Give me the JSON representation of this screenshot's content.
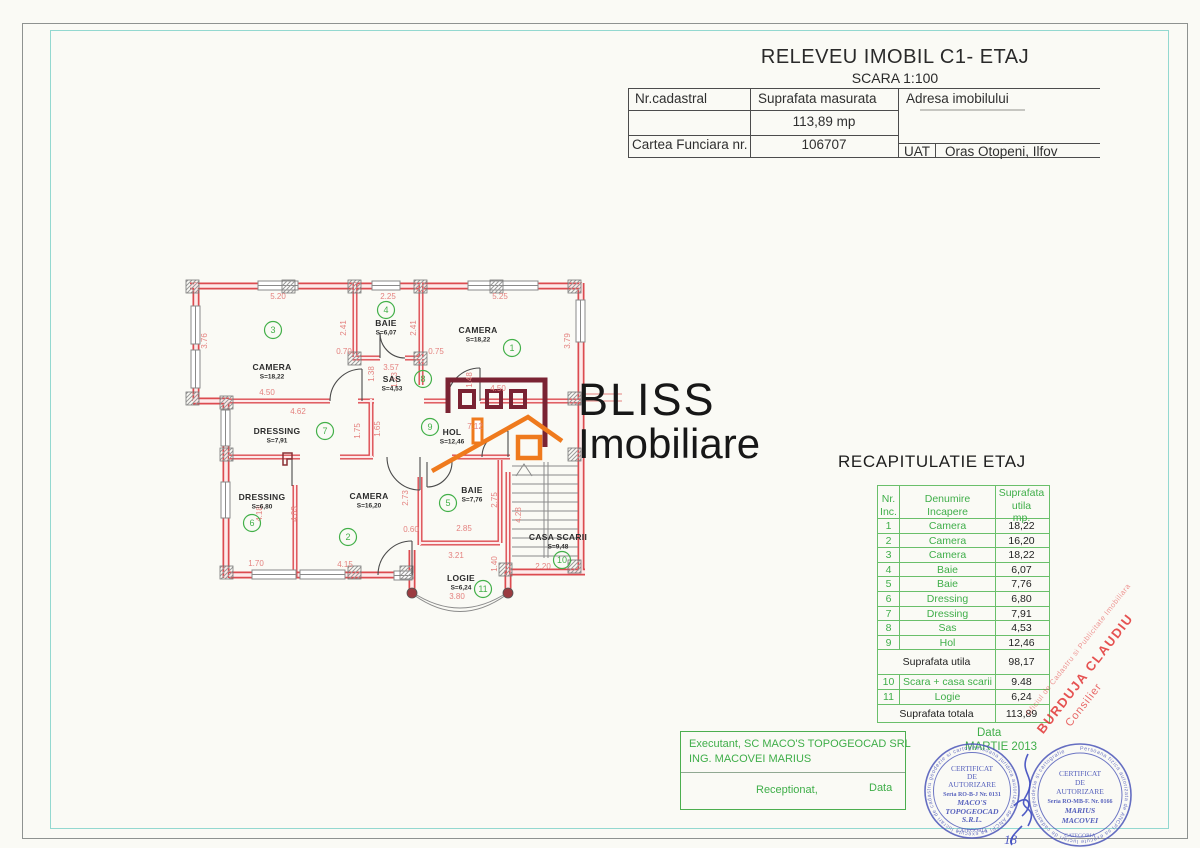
{
  "page": {
    "title": "RELEVEU IMOBIL C1- ETAJ",
    "subtitle": "SCARA 1:100"
  },
  "header_table": {
    "col1": "Nr.cadastral",
    "col2": "Suprafata masurata",
    "col3": "Adresa imobilului",
    "measured_area": "113,89 mp",
    "row2_label": "Cartea Funciara nr.",
    "row2_value": "106707",
    "uat_label": "UAT",
    "uat_value": "Oras Otopeni, Ilfov"
  },
  "logo": {
    "line1": "BLISS",
    "line2": "Imobiliare",
    "maroon": "#7a2333",
    "orange": "#ef7a1d"
  },
  "recap": {
    "title": "RECAPITULATIE ETAJ",
    "header": {
      "c1": [
        "Nr.",
        "Inc."
      ],
      "c2": [
        "Denumire",
        "Incapere"
      ],
      "c3": [
        "Suprafata",
        "utila",
        "mp."
      ]
    },
    "rows": [
      {
        "nr": "1",
        "name": "Camera",
        "val": "18,22"
      },
      {
        "nr": "2",
        "name": "Camera",
        "val": "16,20"
      },
      {
        "nr": "3",
        "name": "Camera",
        "val": "18,22"
      },
      {
        "nr": "4",
        "name": "Baie",
        "val": "6,07"
      },
      {
        "nr": "5",
        "name": "Baie",
        "val": "7,76"
      },
      {
        "nr": "6",
        "name": "Dressing",
        "val": "6,80"
      },
      {
        "nr": "7",
        "name": "Dressing",
        "val": "7,91"
      },
      {
        "nr": "8",
        "name": "Sas",
        "val": "4,53"
      },
      {
        "nr": "9",
        "name": "Hol",
        "val": "12,46"
      }
    ],
    "subtotal": {
      "label": "Suprafata utila",
      "val": "98,17"
    },
    "rows2": [
      {
        "nr": "10",
        "name": "Scara + casa scarii",
        "val": "9.48"
      },
      {
        "nr": "11",
        "name": "Logie",
        "val": "6,24"
      }
    ],
    "total": {
      "label": "Suprafata totala",
      "val": "113,89"
    }
  },
  "floorplan": {
    "wall_color": "#dc4b50",
    "accent_green": "#43b049",
    "dim_color": "#e4827f",
    "rooms": [
      {
        "n": "1",
        "name": "CAMERA",
        "area": "S=18,22",
        "nx": 478,
        "ny": 333,
        "cx": 512,
        "cy": 348
      },
      {
        "n": "2",
        "name": "CAMERA",
        "area": "S=16,20",
        "nx": 369,
        "ny": 499,
        "cx": 348,
        "cy": 537
      },
      {
        "n": "3",
        "name": "CAMERA",
        "area": "S=18,22",
        "nx": 272,
        "ny": 370,
        "cx": 273,
        "cy": 330
      },
      {
        "n": "4",
        "name": "BAIE",
        "area": "S=6,07",
        "nx": 386,
        "ny": 326,
        "cx": 386,
        "cy": 310
      },
      {
        "n": "5",
        "name": "BAIE",
        "area": "S=7,76",
        "nx": 472,
        "ny": 493,
        "cx": 448,
        "cy": 503
      },
      {
        "n": "6",
        "name": "DRESSING",
        "area": "S=6,80",
        "nx": 262,
        "ny": 500,
        "cx": 252,
        "cy": 523
      },
      {
        "n": "7",
        "name": "DRESSING",
        "area": "S=7,91",
        "nx": 277,
        "ny": 434,
        "cx": 325,
        "cy": 431
      },
      {
        "n": "8",
        "name": "SAS",
        "area": "S=4,53",
        "nx": 392,
        "ny": 382,
        "cx": 423,
        "cy": 379
      },
      {
        "n": "9",
        "name": "HOL",
        "area": "S=12,46",
        "nx": 452,
        "ny": 435,
        "cx": 430,
        "cy": 427
      },
      {
        "n": "10",
        "name": "CASA SCARII",
        "area": "S=9,48",
        "nx": 558,
        "ny": 540,
        "cx": 562,
        "cy": 560
      },
      {
        "n": "11",
        "name": "LOGIE",
        "area": "S=6,24",
        "nx": 461,
        "ny": 581,
        "cx": 483,
        "cy": 589
      }
    ],
    "dims": [
      {
        "t": "5.20",
        "x": 278,
        "y": 299
      },
      {
        "t": "2.25",
        "x": 388,
        "y": 299
      },
      {
        "t": "5.25",
        "x": 500,
        "y": 299
      },
      {
        "t": "3.76",
        "x": 207,
        "y": 341,
        "v": 1
      },
      {
        "t": "2.41",
        "x": 346,
        "y": 328,
        "v": 1
      },
      {
        "t": "2.41",
        "x": 416,
        "y": 328,
        "v": 1
      },
      {
        "t": "3.79",
        "x": 570,
        "y": 341,
        "v": 1
      },
      {
        "t": "0.70",
        "x": 344,
        "y": 354
      },
      {
        "t": "0.75",
        "x": 436,
        "y": 354
      },
      {
        "t": "3.57",
        "x": 391,
        "y": 370
      },
      {
        "t": "1.38",
        "x": 374,
        "y": 374,
        "v": 1
      },
      {
        "t": "1.23",
        "x": 397,
        "y": 380,
        "v": 1
      },
      {
        "t": "1.48",
        "x": 472,
        "y": 380,
        "v": 1
      },
      {
        "t": "4.50",
        "x": 267,
        "y": 395
      },
      {
        "t": "4.50",
        "x": 498,
        "y": 391
      },
      {
        "t": "4.62",
        "x": 298,
        "y": 414
      },
      {
        "t": "1.75",
        "x": 360,
        "y": 431,
        "v": 1
      },
      {
        "t": "1.65",
        "x": 380,
        "y": 429,
        "v": 1
      },
      {
        "t": "7.12",
        "x": 475,
        "y": 429
      },
      {
        "t": "4.18",
        "x": 262,
        "y": 514,
        "v": 1
      },
      {
        "t": "4.03",
        "x": 297,
        "y": 514,
        "v": 1
      },
      {
        "t": "2.73",
        "x": 408,
        "y": 498,
        "v": 1
      },
      {
        "t": "2.75",
        "x": 497,
        "y": 500,
        "v": 1
      },
      {
        "t": "0.60",
        "x": 411,
        "y": 532
      },
      {
        "t": "2.85",
        "x": 464,
        "y": 531
      },
      {
        "t": "4.28",
        "x": 521,
        "y": 515,
        "v": 1
      },
      {
        "t": "2.20",
        "x": 543,
        "y": 569
      },
      {
        "t": "1.70",
        "x": 256,
        "y": 566
      },
      {
        "t": "4.15",
        "x": 345,
        "y": 567
      },
      {
        "t": "3.21",
        "x": 456,
        "y": 558
      },
      {
        "t": "1.40",
        "x": 497,
        "y": 564,
        "v": 1
      },
      {
        "t": "3.80",
        "x": 457,
        "y": 599
      }
    ]
  },
  "footer": {
    "executant_line1": "Executant, SC MACO'S TOPOGEOCAD SRL",
    "executant_line2": "ING. MACOVEI MARIUS",
    "receptionat": "Receptionat,",
    "data_label": "Data",
    "date_label": "Data",
    "date_value": "MARTIE 2013"
  },
  "stamps": [
    {
      "ring": "Persoana juridica autorizata de ANCPI sa execute lucrari de cadastru geodezie si cartografie",
      "lines": [
        "CERTIFICAT",
        "DE",
        "AUTORIZARE",
        "Seria RO-B-J Nr. 0131",
        "MACO'S",
        "TOPOGEOCAD",
        "S.R.L."
      ],
      "bottom": "CATEGORIA"
    },
    {
      "ring": "Persoana fizica autorizata de ANCPI sa execute lucrari de cadastru geodezie si cartografie",
      "lines": [
        "CERTIFICAT",
        "DE",
        "AUTORIZARE",
        "Seria RO-MB-F. Nr. 0166",
        "MARIUS",
        "MACOVEI"
      ],
      "bottom": "CATEGORIA"
    }
  ],
  "red_stamp": {
    "line1": "Oficiul de Cadastru si Publicitate Imobiliara",
    "line2": "BURDUJA CLAUDIU",
    "line3": "Consilier"
  },
  "handwriting": {
    "number": "18"
  }
}
